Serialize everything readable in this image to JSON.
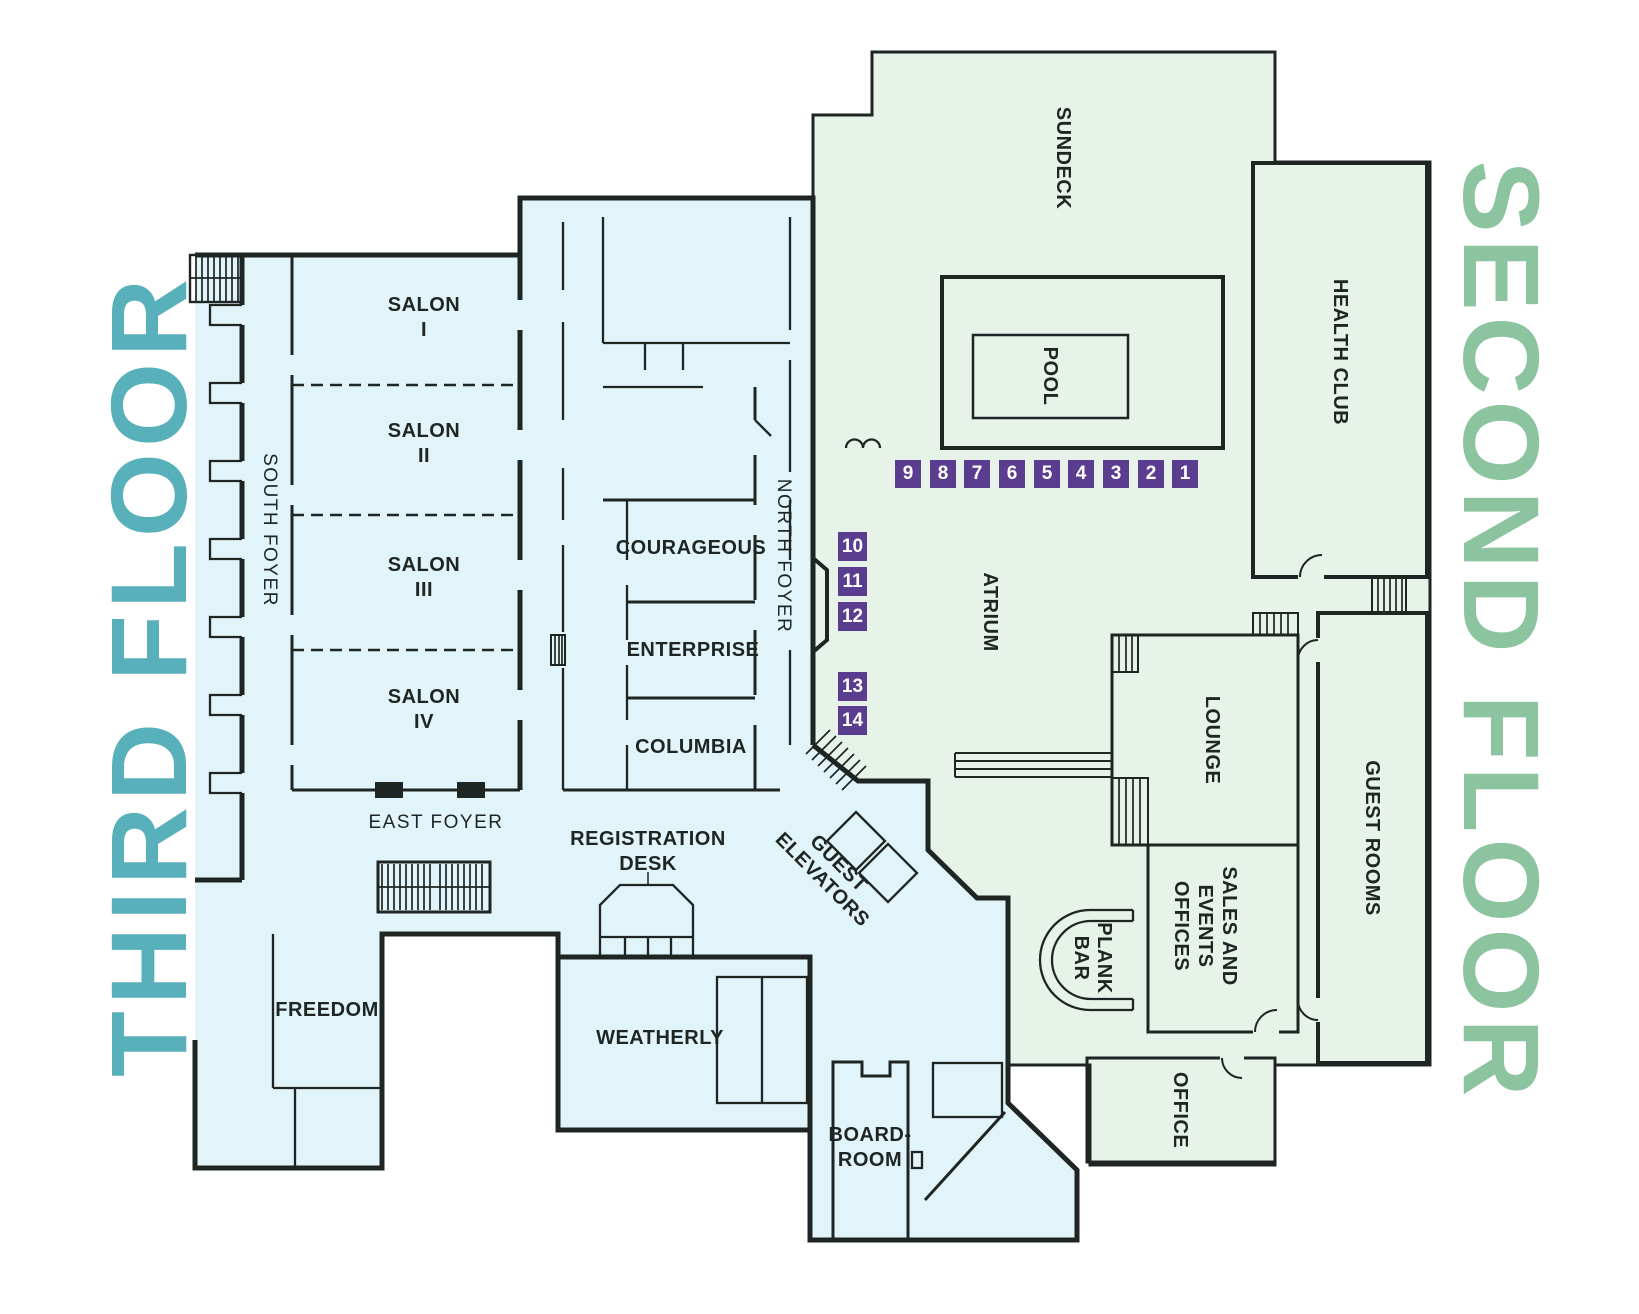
{
  "titles": {
    "third": "THIRD FLOOR",
    "second": "SECOND FLOOR"
  },
  "colors": {
    "third_floor_fill": "#e1f4f9",
    "second_floor_fill": "#e7f2e9",
    "third_title": "#58b1ba",
    "second_title": "#8cc4a0",
    "wall": "#1e2523",
    "badge_bg": "#5a3d8f",
    "badge_text": "#ffffff"
  },
  "third_floor": {
    "salon1": {
      "l1": "SALON",
      "l2": "I"
    },
    "salon2": {
      "l1": "SALON",
      "l2": "II"
    },
    "salon3": {
      "l1": "SALON",
      "l2": "III"
    },
    "salon4": {
      "l1": "SALON",
      "l2": "IV"
    },
    "south_foyer": "SOUTH FOYER",
    "north_foyer": "NORTH FOYER",
    "east_foyer": "EAST FOYER",
    "courageous": "COURAGEOUS",
    "enterprise": "ENTERPRISE",
    "columbia": "COLUMBIA",
    "registration": {
      "l1": "REGISTRATION",
      "l2": "DESK"
    },
    "guest_elevators": {
      "l1": "GUEST",
      "l2": "ELEVATORS"
    },
    "freedom": "FREEDOM",
    "weatherly": "WEATHERLY",
    "boardroom": {
      "l1": "BOARD-",
      "l2": "ROOM"
    }
  },
  "second_floor": {
    "sundeck": "SUNDECK",
    "pool": "POOL",
    "health_club": "HEALTH CLUB",
    "atrium": "ATRIUM",
    "lounge": "LOUNGE",
    "guest_rooms": "GUEST ROOMS",
    "sales": {
      "l1": "SALES AND",
      "l2": "EVENTS",
      "l3": "OFFICES"
    },
    "plank_bar": {
      "l1": "PLANK",
      "l2": "BAR"
    },
    "office": "OFFICE"
  },
  "badges": {
    "row": [
      "9",
      "8",
      "7",
      "6",
      "5",
      "4",
      "3",
      "2",
      "1"
    ],
    "column": [
      "10",
      "11",
      "12",
      "13",
      "14"
    ]
  }
}
